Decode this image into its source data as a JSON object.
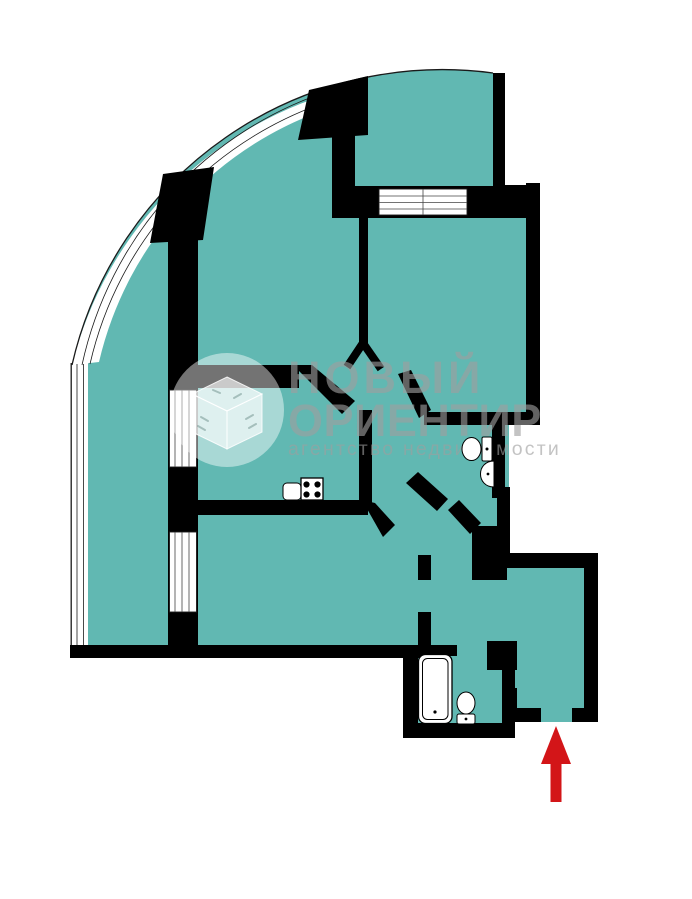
{
  "document": {
    "kind": "apartment floor plan screenshot",
    "background": "#ffffff"
  },
  "colors": {
    "room_fill": "#61B8B2",
    "wall": "#000000",
    "window": "#FFFFFF",
    "outline": "#1A1A1A",
    "entrance_arrow": "#D31518",
    "watermark_text": "rgba(158,158,158,0.62)",
    "watermark_circle": "rgba(255,255,255,0.45)"
  },
  "watermark": {
    "logo": "isometric-open-box-in-circle",
    "title_line1": "НОВЫЙ",
    "title_line2": "ОРИЕНТИР",
    "subtitle": "агентство недвижимости"
  },
  "floorplan": {
    "features": [
      "curved glazed balcony along upper-left quarter arc",
      "top bay room with window band below it",
      "two balcony windows on left wall",
      "central hallway with diagonal walls",
      "toilet room with WC and washbasin",
      "bathroom with bathtub and WC",
      "entrance hall bottom-right with door gap"
    ],
    "fixtures": [
      {
        "name": "kitchen-sink"
      },
      {
        "name": "stove",
        "burners": 4
      },
      {
        "name": "toilet"
      },
      {
        "name": "washbasin"
      },
      {
        "name": "bathtub"
      },
      {
        "name": "toilet"
      }
    ],
    "entrance": {
      "indicator": "red arrow pointing up at entry door gap"
    }
  }
}
